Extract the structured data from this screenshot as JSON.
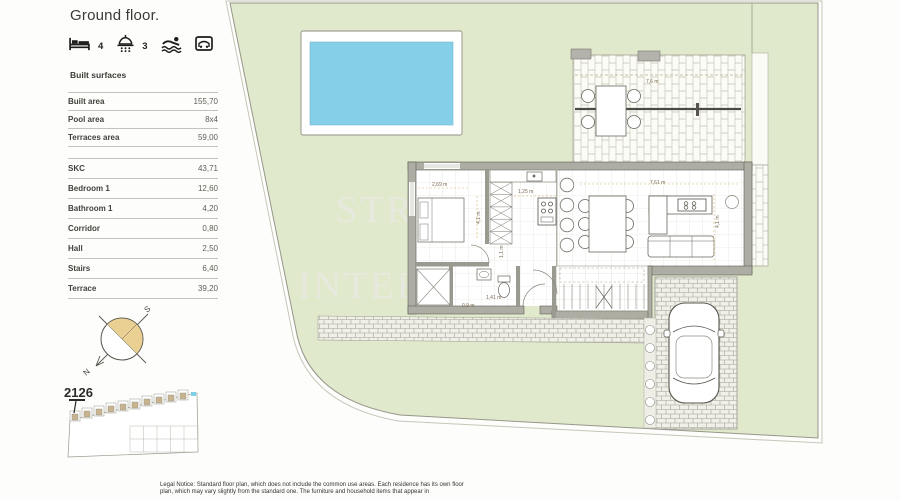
{
  "header": {
    "title": "Ground floor."
  },
  "amenities": {
    "bedrooms": "4",
    "bathrooms": "3"
  },
  "built_surfaces": {
    "heading": "Built surfaces",
    "summary": [
      {
        "label": "Built area",
        "value": "155,70"
      },
      {
        "label": "Pool area",
        "value": "8x4"
      },
      {
        "label": "Terraces area",
        "value": "59,00"
      }
    ],
    "rooms": [
      {
        "label": "SKC",
        "value": "43,71"
      },
      {
        "label": "Bedroom 1",
        "value": "12,60"
      },
      {
        "label": "Bathroom 1",
        "value": "4,20"
      },
      {
        "label": "Corridor",
        "value": "0,80"
      },
      {
        "label": "Hall",
        "value": "2,50"
      },
      {
        "label": "Stairs",
        "value": "6,40"
      },
      {
        "label": "Terrace",
        "value": "39,20"
      }
    ]
  },
  "plan": {
    "unit_number": "2126",
    "compass": {
      "north": "N",
      "south": "S"
    },
    "watermark": {
      "line1": "STR",
      "line2": "INTER"
    },
    "dimensions": {
      "bedroom_width": "2,69 m",
      "bedroom_depth": "4,1 m",
      "kitchen": "1,25 m",
      "hall": "1,1 m",
      "bathroom": "1,41 m",
      "shower": "0,9 m",
      "living_width": "7,61 m",
      "living_depth": "4,1 m",
      "terrace": "7,6 m",
      "driveway": "2,94 m"
    }
  },
  "legal": {
    "line1": "Legal Notice: Standard floor plan, which does not include the common use areas. Each residence has its own",
    "line2": "floor plan, which may vary slightly from the standard one. The furniture and household items that appear in"
  },
  "colors": {
    "site_green": "#e1e9cc",
    "pool_blue": "#85cfe8",
    "compass_gold": "#ead092",
    "dimension_tan": "#d8b26a"
  }
}
